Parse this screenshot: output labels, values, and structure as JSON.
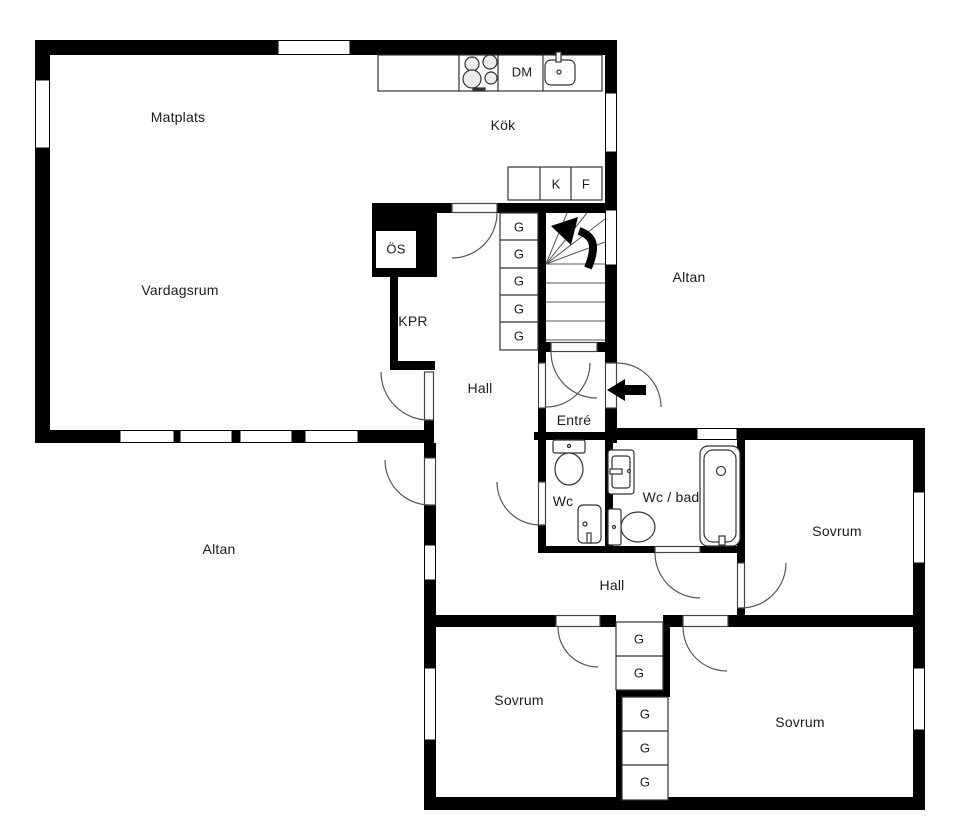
{
  "floorplan": {
    "rooms": {
      "matplats": "Matplats",
      "kok": "Kök",
      "vardagsrum": "Vardagsrum",
      "hall_upper": "Hall",
      "kpr": "KPR",
      "altan_upper": "Altan",
      "entre": "Entré",
      "wc": "Wc",
      "wc_bad": "Wc / bad",
      "sovrum_right": "Sovrum",
      "hall_lower": "Hall",
      "altan_lower": "Altan",
      "sovrum_bottom_left": "Sovrum",
      "sovrum_bottom_right": "Sovrum"
    },
    "fixtures": {
      "os": "ÖS",
      "dm": "DM",
      "kyl": "K",
      "frys": "F",
      "garderob": "G"
    },
    "colors": {
      "wall": "#000000",
      "background": "#ffffff",
      "line": "#2b2b2b"
    }
  }
}
